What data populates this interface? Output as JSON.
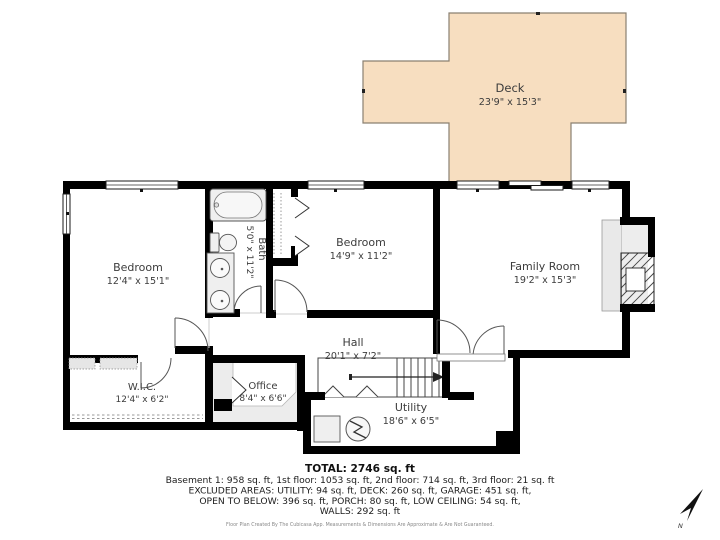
{
  "rooms": {
    "deck": {
      "name": "Deck",
      "dims": "23'9\" x 15'3\""
    },
    "bedroom1": {
      "name": "Bedroom",
      "dims": "12'4\" x 15'1\""
    },
    "bath": {
      "name": "Bath",
      "dims": "5'0\" x 11'2\""
    },
    "bedroom2": {
      "name": "Bedroom",
      "dims": "14'9\" x 11'2\""
    },
    "family_room": {
      "name": "Family Room",
      "dims": "19'2\" x 15'3\""
    },
    "wic": {
      "name": "W.I.C.",
      "dims": "12'4\" x 6'2\""
    },
    "office": {
      "name": "Office",
      "dims": "8'4\" x 6'6\""
    },
    "hall": {
      "name": "Hall",
      "dims": "20'1\" x 7'2\""
    },
    "utility": {
      "name": "Utility",
      "dims": "18'6\" x 6'5\""
    }
  },
  "summary": {
    "total": "TOTAL: 2746 sq. ft",
    "line1": "Basement 1: 958 sq. ft, 1st floor: 1053 sq. ft, 2nd floor: 714 sq. ft, 3rd floor: 21 sq. ft",
    "line2": "EXCLUDED AREAS: UTILITY: 94 sq. ft, DECK: 260 sq. ft, GARAGE: 451 sq. ft,",
    "line3": "OPEN TO BELOW: 396 sq. ft, PORCH: 80 sq. ft, LOW CEILING: 54 sq. ft,",
    "line4": "WALLS: 292 sq. ft"
  },
  "disclaimer": "Floor Plan Created By The Cubicasa App. Measurements & Dimensions Are Approximate & Are Not Guaranteed.",
  "compass": {
    "label": "N"
  },
  "colors": {
    "deck_fill": "#f7dec0",
    "deck_outline": "#8a8071",
    "wall": "#000000",
    "fixture_fill": "#efefef",
    "low_ceiling_fill": "#ececec",
    "label_text": "#3c3c3c"
  }
}
